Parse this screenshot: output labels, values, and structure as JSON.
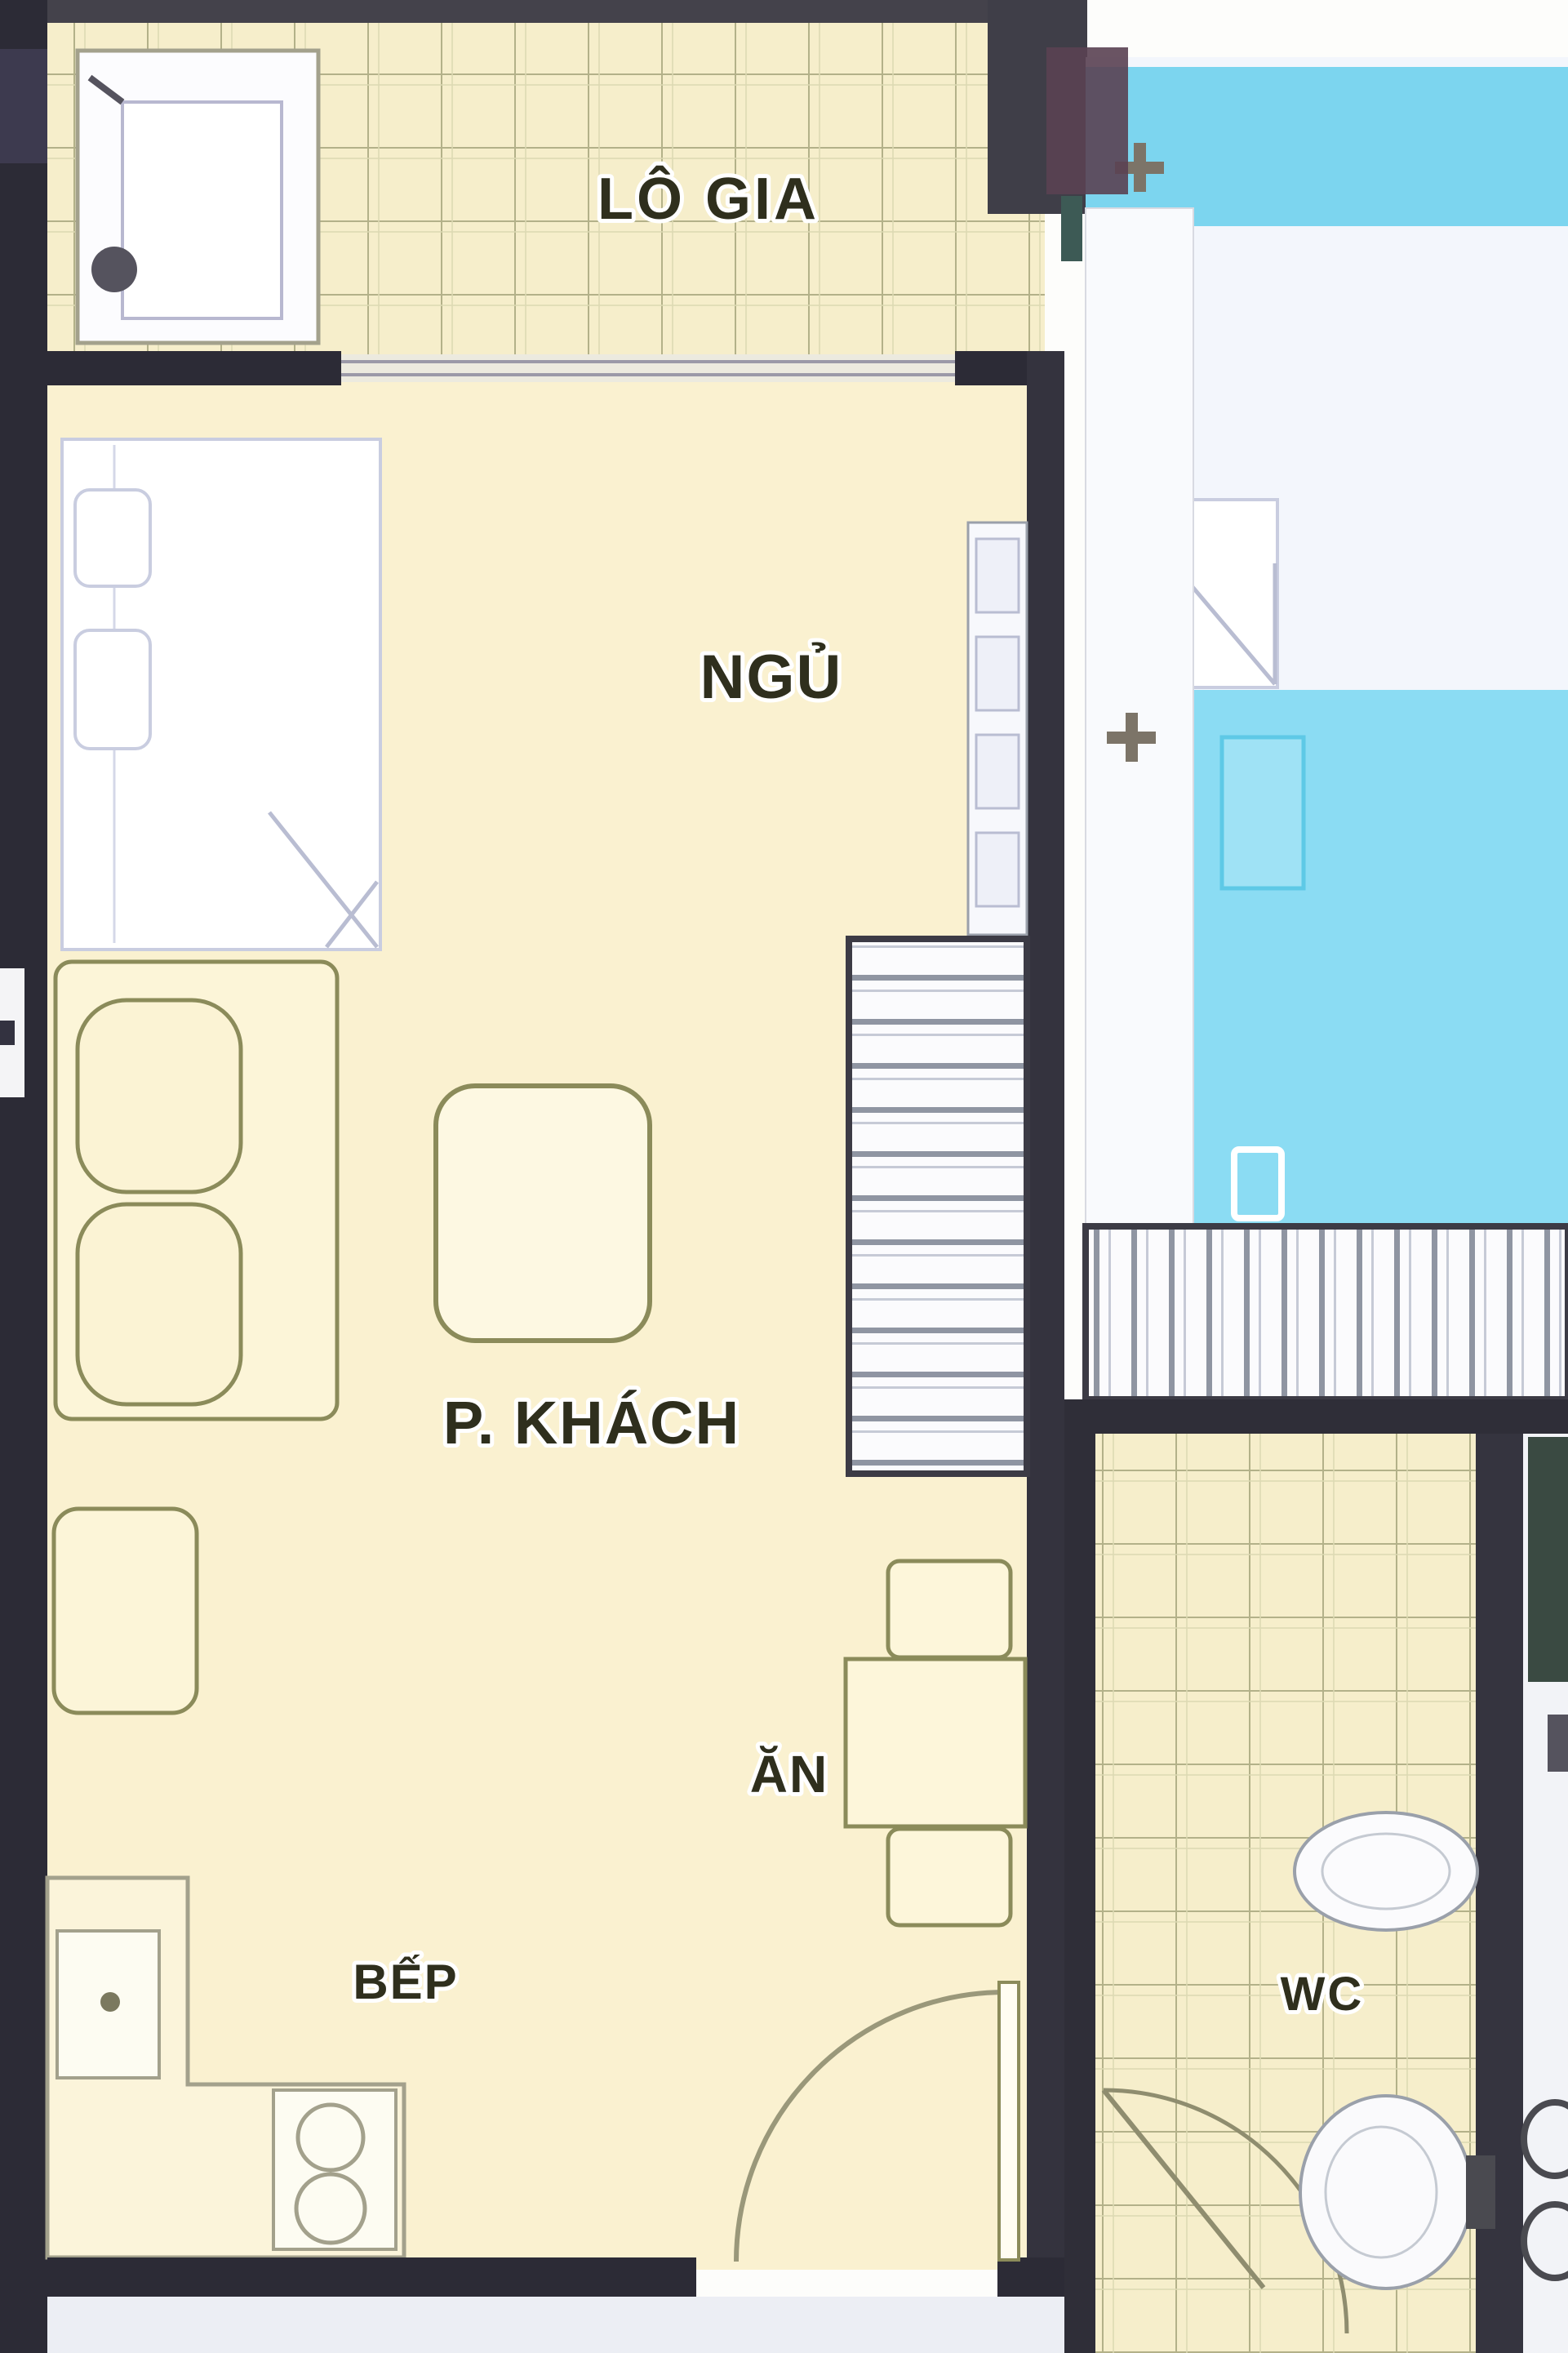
{
  "title": "Apartment floor plan",
  "plan": {
    "rooms": {
      "loggia": {
        "label": "LÔ GIA"
      },
      "bedroom": {
        "label": "NGỦ"
      },
      "living": {
        "label": "P. KHÁCH"
      },
      "dining": {
        "label": "ĂN"
      },
      "kitchen": {
        "label": "BẾP"
      },
      "wc": {
        "label": "WC"
      }
    },
    "colors": {
      "floor_cream": "#faf1d0",
      "tile_cream": "#f6eecb",
      "tile_line": "#b3b189",
      "blue_band": "#7cd5ef",
      "blue_floor": "#8bdcf3",
      "pale_room": "#f3f6fc",
      "wall_dark": "#2c2b36",
      "wall_medium": "#3f3e48",
      "wall_divider": "#34333e",
      "furniture_outline": "#8b8b5a",
      "bed_outline": "#c9cde0",
      "label_ink": "#2f2f1d",
      "exterior_band": "#eceef4"
    }
  }
}
